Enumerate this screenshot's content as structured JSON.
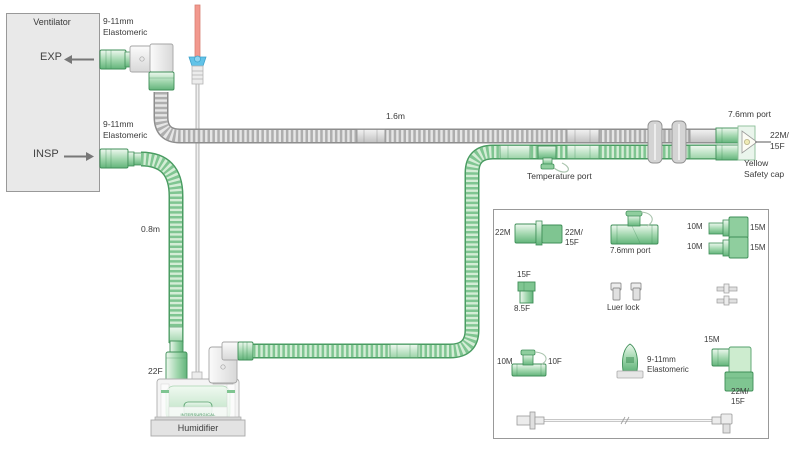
{
  "ventilator": {
    "title": "Ventilator",
    "exp": "EXP",
    "insp": "INSP"
  },
  "circuit": {
    "exp_adapter": {
      "line1": "9-11mm",
      "line2": "Elastomeric"
    },
    "insp_adapter": {
      "line1": "9-11mm",
      "line2": "Elastomeric"
    },
    "exp_limb_length": "1.6m",
    "insp_limb_length": "0.8m",
    "port_label": "7.6mm port",
    "patient_end": {
      "line1": "22M/",
      "line2": "15F"
    },
    "safety_cap": {
      "line1": "Yellow",
      "line2": "Safety cap"
    },
    "temperature_port": "Temperature port",
    "humidifier_inlet": "22F",
    "humidifier_label": "Humidifier",
    "humidifier_brand": "INTERSURGICAL"
  },
  "legend": {
    "straight_connector": {
      "left": "22M",
      "right1": "22M/",
      "right2": "15F"
    },
    "port_tee_label": "7.6mm port",
    "adapters": [
      {
        "left": "10M",
        "right": "15M"
      },
      {
        "left": "10M",
        "right": "15M"
      }
    ],
    "catheter_connector": {
      "top": "15F",
      "bottom": "8.5F"
    },
    "luer_lock_label": "Luer lock",
    "tee": {
      "left": "10M",
      "right": "10F"
    },
    "elastomeric": {
      "line1": "9-11mm",
      "line2": "Elastomeric"
    },
    "elbow": {
      "top": "15M",
      "bottom1": "22M/",
      "bottom2": "15F"
    }
  },
  "colors": {
    "tube_green": "#7fc591",
    "green_dark": "#3f8f58",
    "green_light": "#d4edd6",
    "tube_gray": "#aeaeae",
    "probe_red": "#f2998e",
    "probe_blue": "#62c3e8",
    "cap_yellow": "#efeab4"
  }
}
